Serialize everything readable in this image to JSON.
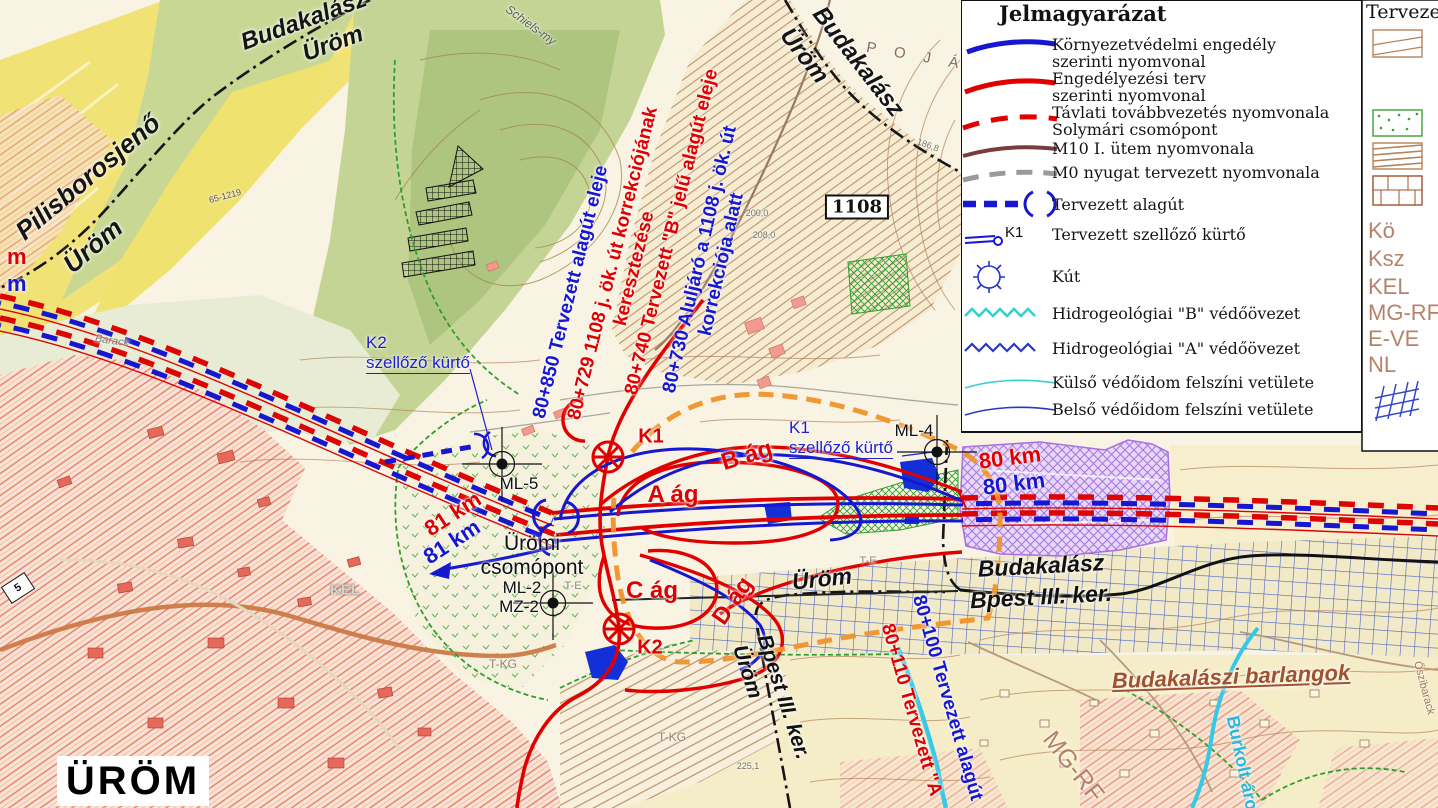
{
  "legend": {
    "title": "Jelmagyarázat",
    "right_title": "Tervezett",
    "entries": {
      "env": {
        "l1": "Környezetvédelmi engedély",
        "l2": "szerinti nyomvonal"
      },
      "terv": {
        "l1": "Engedélyezési terv",
        "l2": "szerinti nyomvonal"
      },
      "tavlati": {
        "l1": "Távlati továbbvezetés nyomvonala",
        "l2": "Solymári csomópont"
      },
      "m10": {
        "l1": "M10 I. ütem nyomvonala"
      },
      "m0": {
        "l1": "M0 nyugat tervezett nyomvonala"
      },
      "alagut": {
        "l1": "Tervezett alagút"
      },
      "kurto": {
        "l1": "Tervezett szellőző kürtő",
        "tag": "K1"
      },
      "kut": {
        "l1": "Kút"
      },
      "hidroB": {
        "l1": "Hidrogeológiai \"B\" védőövezet"
      },
      "hidroA": {
        "l1": "Hidrogeológiai \"A\" védőövezet"
      },
      "kulso": {
        "l1": "Külső védőidom felszíni vetülete"
      },
      "belso": {
        "l1": "Belső védőidom felszíni vetülete"
      }
    },
    "zones": [
      "Kö",
      "Ksz",
      "KEL",
      "MG-RF",
      "E-VE",
      "NL"
    ]
  },
  "map": {
    "labels": {
      "pilisborosjeno": "Pilisborosjenő",
      "urom_nw": "Üröm",
      "budakalasz_nw": "Budakalász",
      "urom_nw2": "Üröm",
      "budakalasz_ne": "Budakalász",
      "urom_ne": "Üröm",
      "poja": "P O J Á",
      "schiels": "Schiels-my",
      "r1108": "1108",
      "ch_80850": "80+850 Tervezett alagút eleje",
      "ch_80729a": "80+729  1108 j. ök. út korrekciójának",
      "ch_80729b": "keresztezése",
      "ch_80740": "80+740 Tervezett \"B\" jelű alagút eleje",
      "ch_80730a": "80+730 Aluljáró a 1108 j. ök. út",
      "ch_80730b": "korrekciója alatt",
      "k2_id": "K2",
      "k2_kurto": "szellőző kürtő",
      "k1_id_ml4": "K1",
      "k1_kurto_ml4": "szellőző kürtő",
      "ml4": "ML-4",
      "ml5": "ML-5",
      "ml2": "ML-2",
      "mz2": "MZ-2",
      "k1_sym": "K1",
      "k2_sym": "K2",
      "km80_r": "80 km",
      "km80_b": "80 km",
      "km81_r": "81 km",
      "km81_b": "81 km",
      "m_r": "m",
      "m_b": "m",
      "uromi1": "Ürömi",
      "uromi2": "csomópont",
      "ag_a": "A ág",
      "ag_b": "B ág",
      "ag_c": "C ág",
      "ag_d": "D ág",
      "urom_mid": "Üröm",
      "budakalasz_band": "Budakalász",
      "bpest_band": "Bpest III. ker.",
      "bpest_rot": "Bpest III. ker.",
      "urom_rot": "Üröm",
      "ch_80100": "80+100 Tervezett alagút",
      "ch_80110": "80+110 Tervezett \"A",
      "barlangok": "Budakalászi barlangok",
      "burkolt": "Burkolt árok",
      "mgrf": "MG-RF",
      "kel": "KEL",
      "urom_big": "ÜRÖM",
      "te1": "T-E",
      "te2": "T-E",
      "tkg1": "T-KG",
      "tkg2": "T-KG",
      "barack": "Barack",
      "trig": "65-1219",
      "h186": "186,8",
      "h200": "200,0",
      "h208": "208,0",
      "h225": "225,1",
      "oszib": "Őszibarack",
      "sign5": "5"
    }
  },
  "colors": {
    "route_red": "#e00000",
    "route_blue": "#1717cf",
    "orange_dash": "#f0922b",
    "cyan": "#35c8e8",
    "purple": "#a96fe0",
    "legend_brown": "#b5826a"
  }
}
